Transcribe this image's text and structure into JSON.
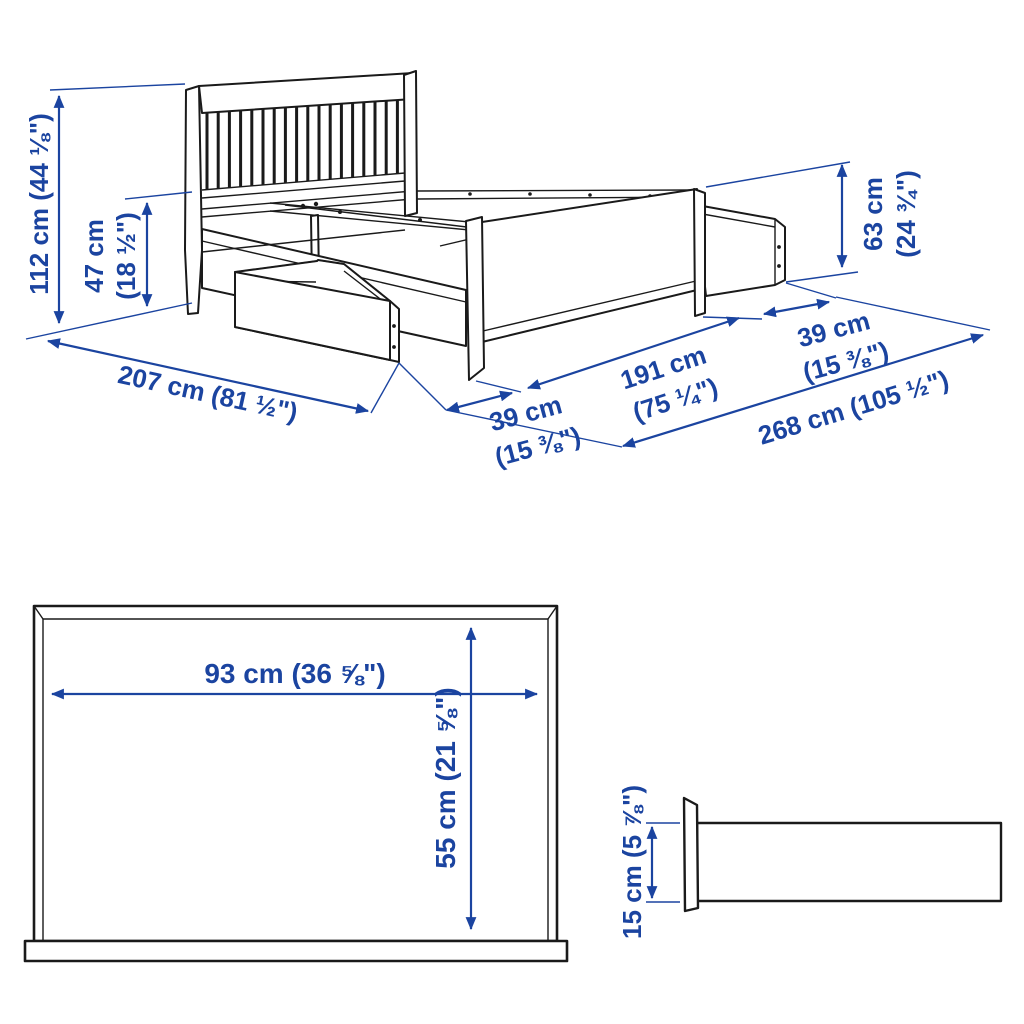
{
  "figure": {
    "type": "product-dimension-diagram",
    "subject": "bed frame with headboard and pull-out storage drawers",
    "accent_color": "#1b44a0",
    "line_color": "#1a1a1a",
    "background_color": "#ffffff"
  },
  "views": {
    "isometric": {
      "name": "bed with storage drawers - isometric view",
      "dims": {
        "total_height": {
          "text": "112 cm (44 ⅛\")"
        },
        "base_height": {
          "l1": "47 cm",
          "l2": "(18 ½\")"
        },
        "footboard_height": {
          "l1": "63 cm",
          "l2": "(24 ¾\")"
        },
        "bed_length": {
          "text": "207 cm (81 ½\")"
        },
        "front_drawer_extension": {
          "l1": "39 cm",
          "l2": "(15 ⅜\")"
        },
        "frame_span": {
          "l1": "191 cm",
          "l2": "(75 ¼\")"
        },
        "side_drawer_extension": {
          "l1": "39 cm",
          "l2": "(15 ⅜\")"
        },
        "total_length_drawers_open": {
          "text": "268 cm (105 ½\")"
        }
      }
    },
    "front": {
      "name": "drawer front view",
      "dims": {
        "width": {
          "text": "93 cm (36 ⅝\")"
        },
        "height": {
          "text": "55 cm (21 ⅝\")"
        }
      }
    },
    "side": {
      "name": "storage box side view",
      "dims": {
        "height": {
          "text": "15 cm (5 ⅞\")"
        }
      }
    }
  }
}
